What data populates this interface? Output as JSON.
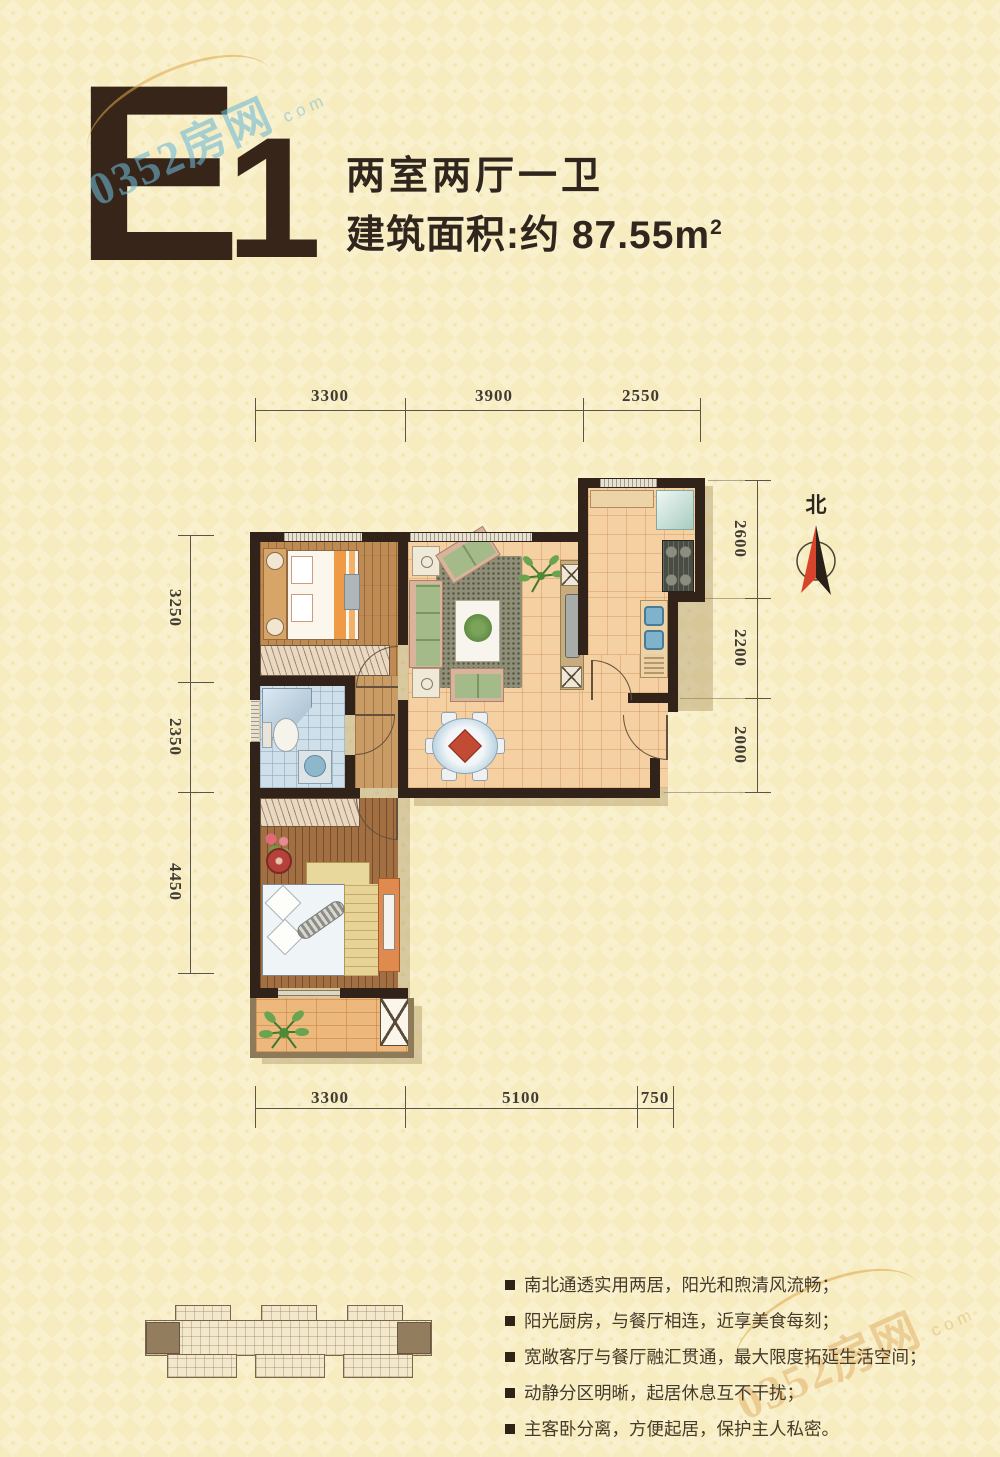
{
  "header": {
    "unit_letter": "E",
    "unit_number": "1",
    "layout_type": "两室两厅一卫",
    "area_prefix": "建筑面积:约 87.55m",
    "area_sup": "2"
  },
  "watermark": {
    "brand": "0352房网",
    "domain_suffix": "com"
  },
  "compass": {
    "north_label": "北"
  },
  "dimensions": {
    "top": [
      "3300",
      "3900",
      "2550"
    ],
    "left": [
      "3250",
      "2350",
      "4450"
    ],
    "right": [
      "2600",
      "2200",
      "2000"
    ],
    "bottom": [
      "3300",
      "5100",
      "750"
    ]
  },
  "features": [
    "南北通透实用两居，阳光和煦清风流畅；",
    "阳光厨房，与餐厅相连，近享美食每刻；",
    "宽敞客厅与餐厅融汇贯通，最大限度拓延生活空间；",
    "动静分区明晰，起居休息互不干扰；",
    "主客卧分离，方便起居，保护主人私密。"
  ],
  "colors": {
    "wall": "#32231a",
    "accent_red": "#d8432c",
    "page_bg": "#f9f1cd"
  }
}
